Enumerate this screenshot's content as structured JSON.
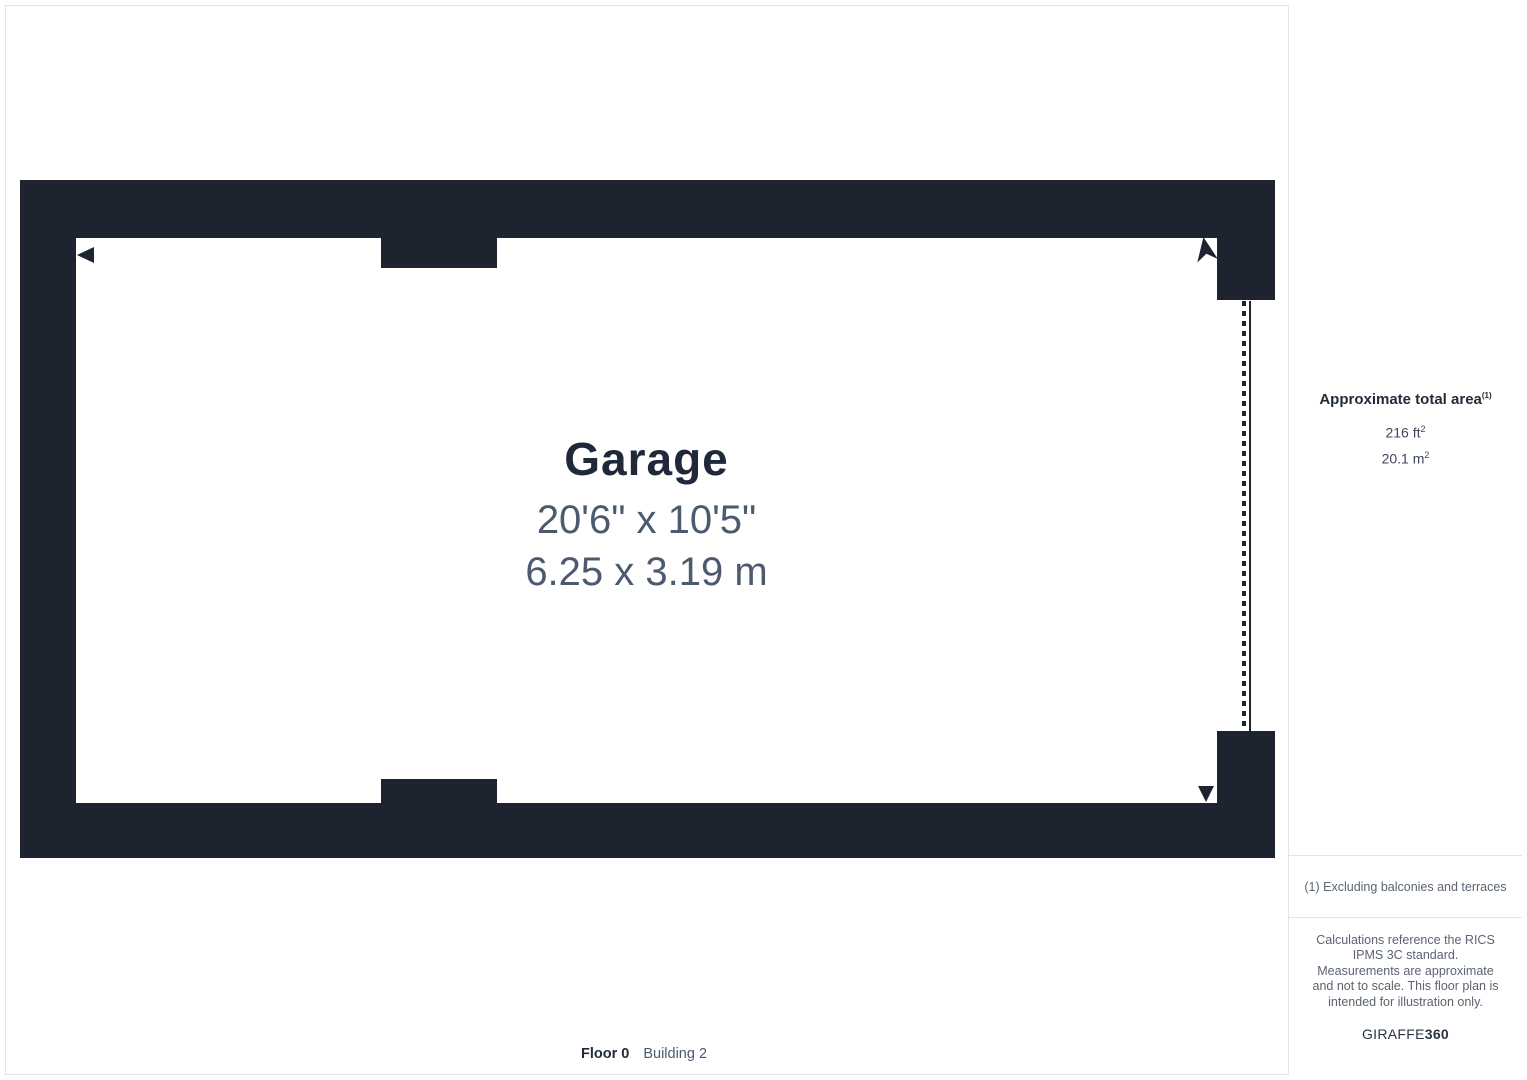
{
  "plan": {
    "room_name": "Garage",
    "room_dimensions_imperial": "20'6\" x 10'5\"",
    "room_dimensions_metric": "6.25 x 3.19 m",
    "floor_label": "Floor 0",
    "building_label": "Building 2"
  },
  "sidebar": {
    "area_title": "Approximate total area",
    "area_title_note_ref": "(1)",
    "area_imperial": "216 ft",
    "area_imperial_exponent": "2",
    "area_metric": "20.1 m",
    "area_metric_exponent": "2",
    "footnote": "(1) Excluding balconies and terraces",
    "disclaimer": "Calculations reference the RICS IPMS 3C standard. Measurements are approximate and not to scale. This floor plan is intended for illustration only.",
    "brand_prefix": "GIRAFFE",
    "brand_suffix": "360"
  },
  "colors": {
    "wall": "#1d2430",
    "room_title_text": "#20293a",
    "dimension_text": "#4c5a70",
    "muted_text": "#5b6472",
    "divider": "#e4e4e4"
  }
}
